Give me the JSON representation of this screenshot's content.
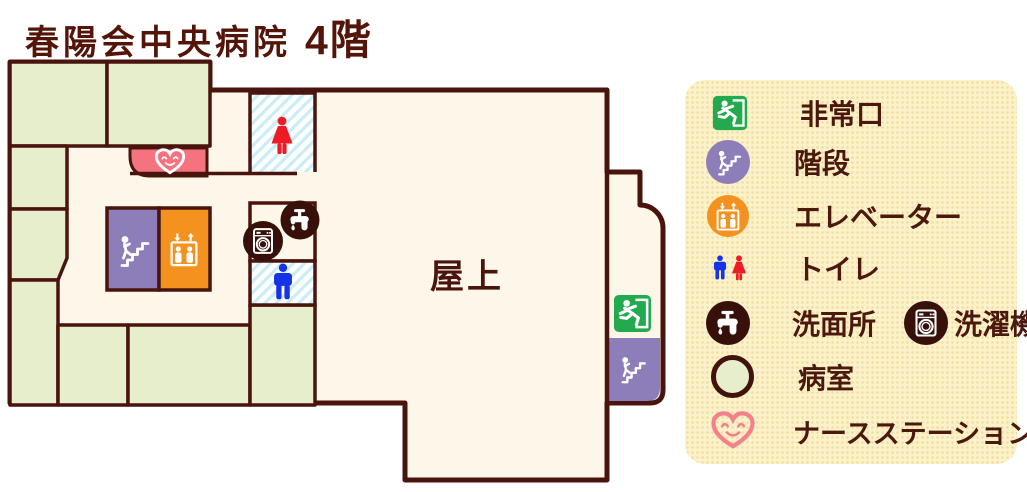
{
  "title": {
    "name": "春陽会中央病院",
    "floor": "4階"
  },
  "map": {
    "rooftop_label": "屋上"
  },
  "legend": {
    "items": [
      {
        "id": "emergency-exit",
        "label": "非常口"
      },
      {
        "id": "stairs",
        "label": "階段"
      },
      {
        "id": "elevator",
        "label": "エレベーター"
      },
      {
        "id": "toilet",
        "label": "トイレ"
      },
      {
        "id": "washstand",
        "label": "洗面所"
      },
      {
        "id": "washing-machine",
        "label": "洗濯機"
      },
      {
        "id": "patient-room",
        "label": "病室"
      },
      {
        "id": "nurse-station",
        "label": "ナースステーション"
      }
    ]
  },
  "colors": {
    "wall": "#4a140e",
    "floor_cream": "#fcf7e8",
    "patient_room_green": "#e7eecb",
    "nurse_pink": "#f4737f",
    "stairs_purple": "#8d7eb9",
    "elevator_orange": "#f3921e",
    "exit_green": "#23a94e",
    "toilet_blue": "#1733e8",
    "toilet_red": "#ed1c24",
    "icon_dark": "#38100a",
    "legend_bg": "#fbf1ca",
    "toilet_stripe": "#c9edf6",
    "text": "#551408"
  }
}
